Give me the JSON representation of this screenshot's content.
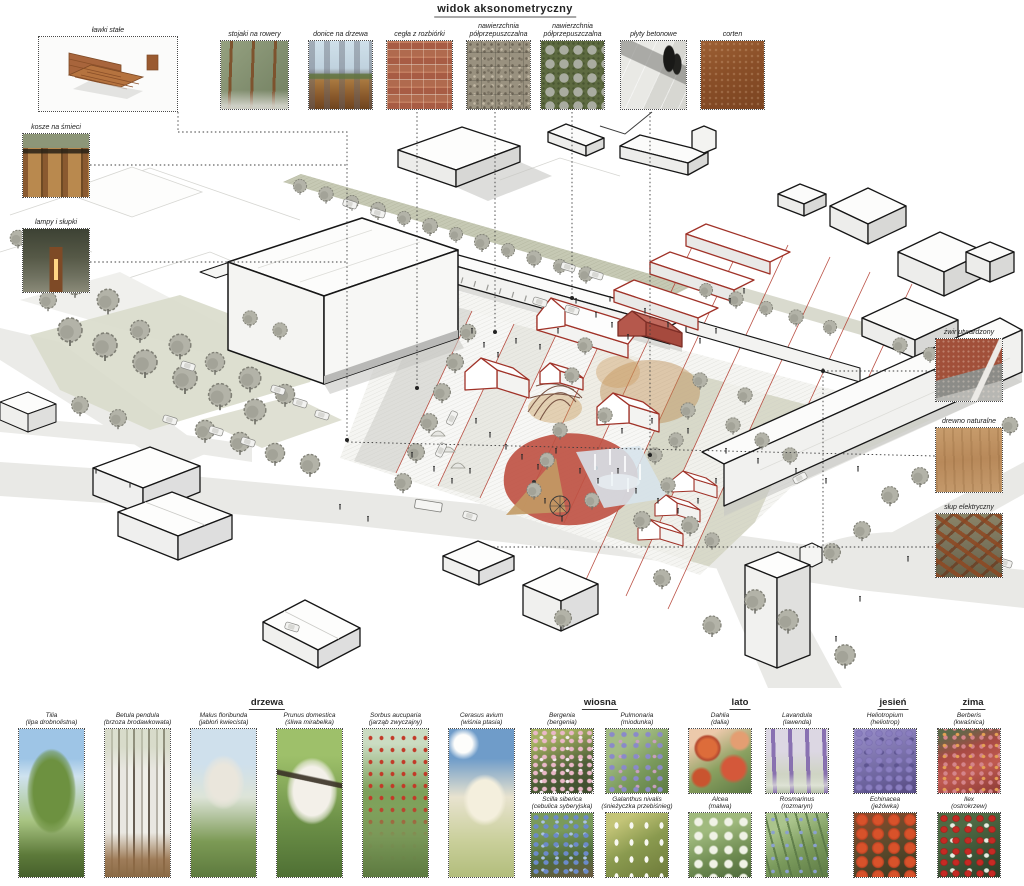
{
  "title": "widok aksonometryczny",
  "legend_left": [
    {
      "label": "ławki stałe"
    },
    {
      "label": "kosze na śmieci"
    },
    {
      "label": "lampy i słupki"
    }
  ],
  "materials_top": [
    {
      "label": "stojaki na rowery"
    },
    {
      "label": "donice na drzewa"
    },
    {
      "label": "cegła z rozbiórki"
    },
    {
      "label": "nawierzchnia półprzepuszczalna"
    },
    {
      "label": "nawierzchnia półprzepuszczalna"
    },
    {
      "label": "płyty betonowe"
    },
    {
      "label": "corten"
    }
  ],
  "legend_right": [
    {
      "label": "żwir utwardzony"
    },
    {
      "label": "drewno naturalne"
    },
    {
      "label": "słup elektryczny"
    }
  ],
  "sections": {
    "trees_heading": "drzewa",
    "spring_heading": "wiosna",
    "summer_heading": "lato",
    "autumn_heading": "jesień",
    "winter_heading": "zima"
  },
  "trees": [
    {
      "latin": "Tilia",
      "polish": "(lipa drobnolistna)"
    },
    {
      "latin": "Betula pendula",
      "polish": "(brzoza brodawkowata)"
    },
    {
      "latin": "Malus floribunda",
      "polish": "(jabłoń kwiecista)"
    },
    {
      "latin": "Prunus domestica",
      "polish": "(śliwa mirabelka)"
    },
    {
      "latin": "Sorbus aucuparia",
      "polish": "(jarząb zwyczajny)"
    },
    {
      "latin": "Cerasus avium",
      "polish": "(wiśnia ptasia)"
    }
  ],
  "plants": {
    "spring": [
      {
        "latin": "Bergenia",
        "polish": "(bergenia)"
      },
      {
        "latin": "Pulmonaria",
        "polish": "(miodunka)"
      },
      {
        "latin": "Scilla siberica",
        "polish": "(cebulica syberyjska)"
      },
      {
        "latin": "Galanthus nivalis",
        "polish": "(śnieżyczka przebiśnieg)"
      }
    ],
    "summer": [
      {
        "latin": "Dahlia",
        "polish": "(dalia)"
      },
      {
        "latin": "Lavandula",
        "polish": "(lawenda)"
      },
      {
        "latin": "Alcea",
        "polish": "(malwa)"
      },
      {
        "latin": "Rosmarinus",
        "polish": "(rozmaryn)"
      }
    ],
    "autumn": [
      {
        "latin": "Heliotropium",
        "polish": "(heliotrop)"
      },
      {
        "latin": "Echinacea",
        "polish": "(jeżówka)"
      }
    ],
    "winter": [
      {
        "latin": "Berberis",
        "polish": "(kwaśnica)"
      },
      {
        "latin": "Ilex",
        "polish": "(ostrokrzew)"
      }
    ]
  },
  "colors": {
    "accent_red": "#a93a2e",
    "corten": "#8a4f28",
    "plaza_red_line": "#b23b2e",
    "fountain_blue": "#d7e4ec",
    "playground_red": "#bf5244",
    "drawing_gray": "#d9d9d9"
  }
}
